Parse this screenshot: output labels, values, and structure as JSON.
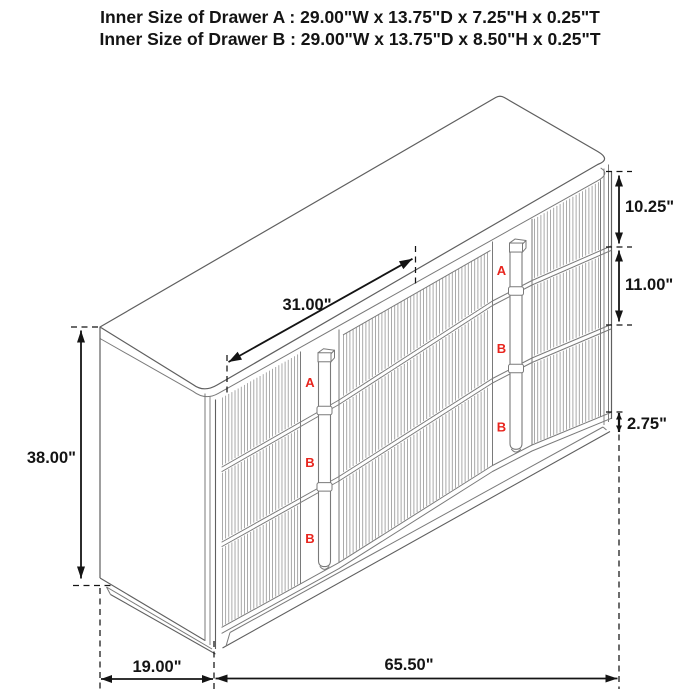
{
  "header": {
    "line1": "Inner Size of Drawer A : 29.00\"W x 13.75\"D x 7.25\"H x 0.25\"T",
    "line2": "Inner Size of Drawer B : 29.00\"W x 13.75\"D x 8.50\"H x 0.25\"T"
  },
  "dimensions": {
    "overall_height": "38.00\"",
    "depth": "19.00\"",
    "overall_width": "65.50\"",
    "top_diagonal": "31.00\"",
    "drawer_a_height": "10.25\"",
    "drawer_b_height": "11.00\"",
    "base_height": "2.75\""
  },
  "drawer_labels": {
    "top": "A",
    "middle": "B",
    "bottom": "B"
  },
  "colors": {
    "dimension": "#141414",
    "outline": "#5f5f5f",
    "inner_line": "#7a7a7a",
    "flute": "#9b9b9b",
    "label_red": "#e8251e",
    "background": "#ffffff"
  }
}
